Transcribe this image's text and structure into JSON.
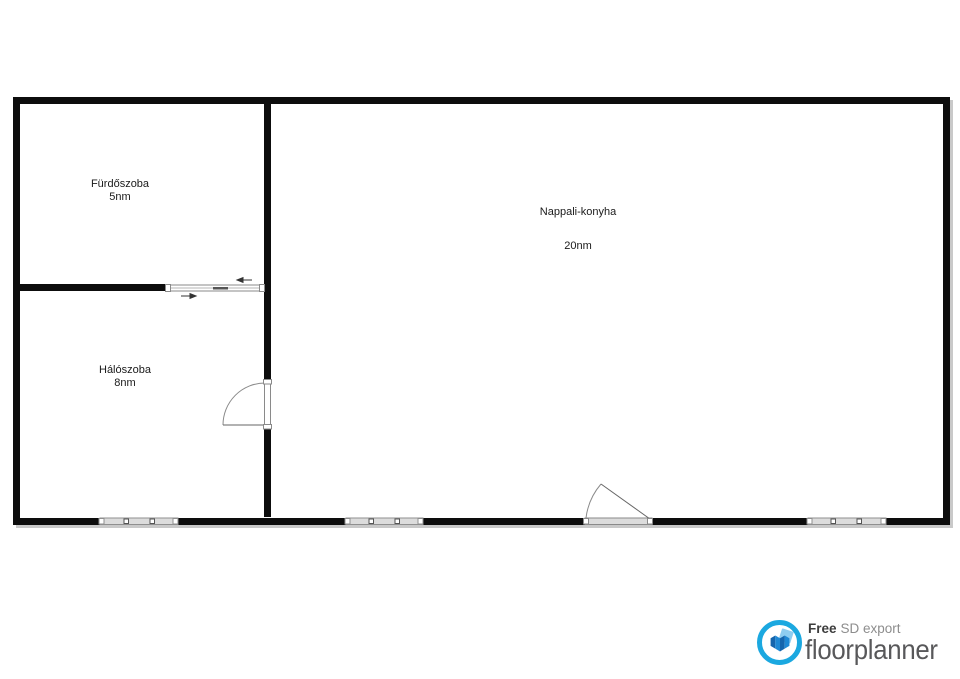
{
  "plan": {
    "rooms": [
      {
        "name": "Fürdőszoba",
        "area": "5nm"
      },
      {
        "name": "Hálószoba",
        "area": "8nm"
      },
      {
        "name": "Nappali-konyha",
        "area": "20nm"
      }
    ]
  },
  "watermark": {
    "symbol": "roof-chevron",
    "monogram": "OC",
    "line1": "OTTHON",
    "line2": "CENTRUM"
  },
  "footer": {
    "free_label": "Free",
    "export_label": "SD export",
    "brand": "floorplanner"
  },
  "colors": {
    "wall": "#0d0d0d",
    "wallShadow": "#c9c9c9",
    "labelColor": "#1a1a1a",
    "doorStroke": "#8a8a8a",
    "doorLeaf": "#666666",
    "windowFill": "#dcdcdc",
    "windowStroke": "#8f8f8f",
    "arrow": "#333333",
    "watermarkGray": "#b3b3b5",
    "fpBlue": "#1ba8e0",
    "fpHouseDark": "#1565ad",
    "fpHouseMid": "#1e88d4",
    "fpHouseLight": "#8ecdf0",
    "fpFree": "#3d3d3d",
    "fpSubtext": "#8d8d8d",
    "fpText": "#58585a"
  }
}
